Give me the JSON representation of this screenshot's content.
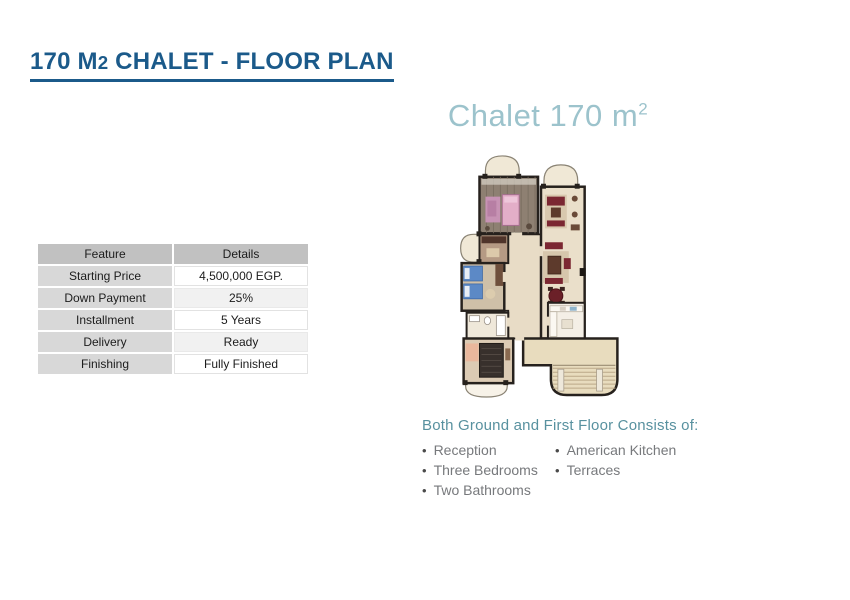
{
  "page": {
    "title": {
      "part1": "170 M",
      "sub": "2",
      "part2": " CHALET - FLOOR PLAN"
    },
    "plan_heading": {
      "text": "Chalet 170 m",
      "sup": "2"
    }
  },
  "spec_table": {
    "headers": [
      "Feature",
      "Details"
    ],
    "rows": [
      {
        "feature": "Starting Price",
        "details": "4,500,000 EGP."
      },
      {
        "feature": "Down Payment",
        "details": "25%"
      },
      {
        "feature": "Installment",
        "details": "5 Years"
      },
      {
        "feature": "Delivery",
        "details": "Ready"
      },
      {
        "feature": "Finishing",
        "details": "Fully Finished"
      }
    ]
  },
  "features": {
    "heading": "Both Ground and First Floor Consists of:",
    "column1": [
      "Reception",
      "Three Bedrooms",
      "Two Bathrooms"
    ],
    "column2": [
      "American Kitchen",
      "Terraces"
    ]
  },
  "icons": {
    "bullet": "•"
  },
  "colors": {
    "title_blue": "#1b5a8a",
    "plan_heading_blue": "#9cc3cc",
    "features_teal": "#58919f",
    "list_gray": "#77797c",
    "table_header_gray": "#c1c1c1",
    "table_feature_gray": "#d8d8d8",
    "plan_wall": "#26211d",
    "plan_floor_beige": "#e8dcc6",
    "plan_wood": "#8e8072",
    "plan_bed_pink": "#e3aec8",
    "plan_bed_blue": "#5c89c6",
    "plan_furniture_maroon": "#7b2732"
  }
}
